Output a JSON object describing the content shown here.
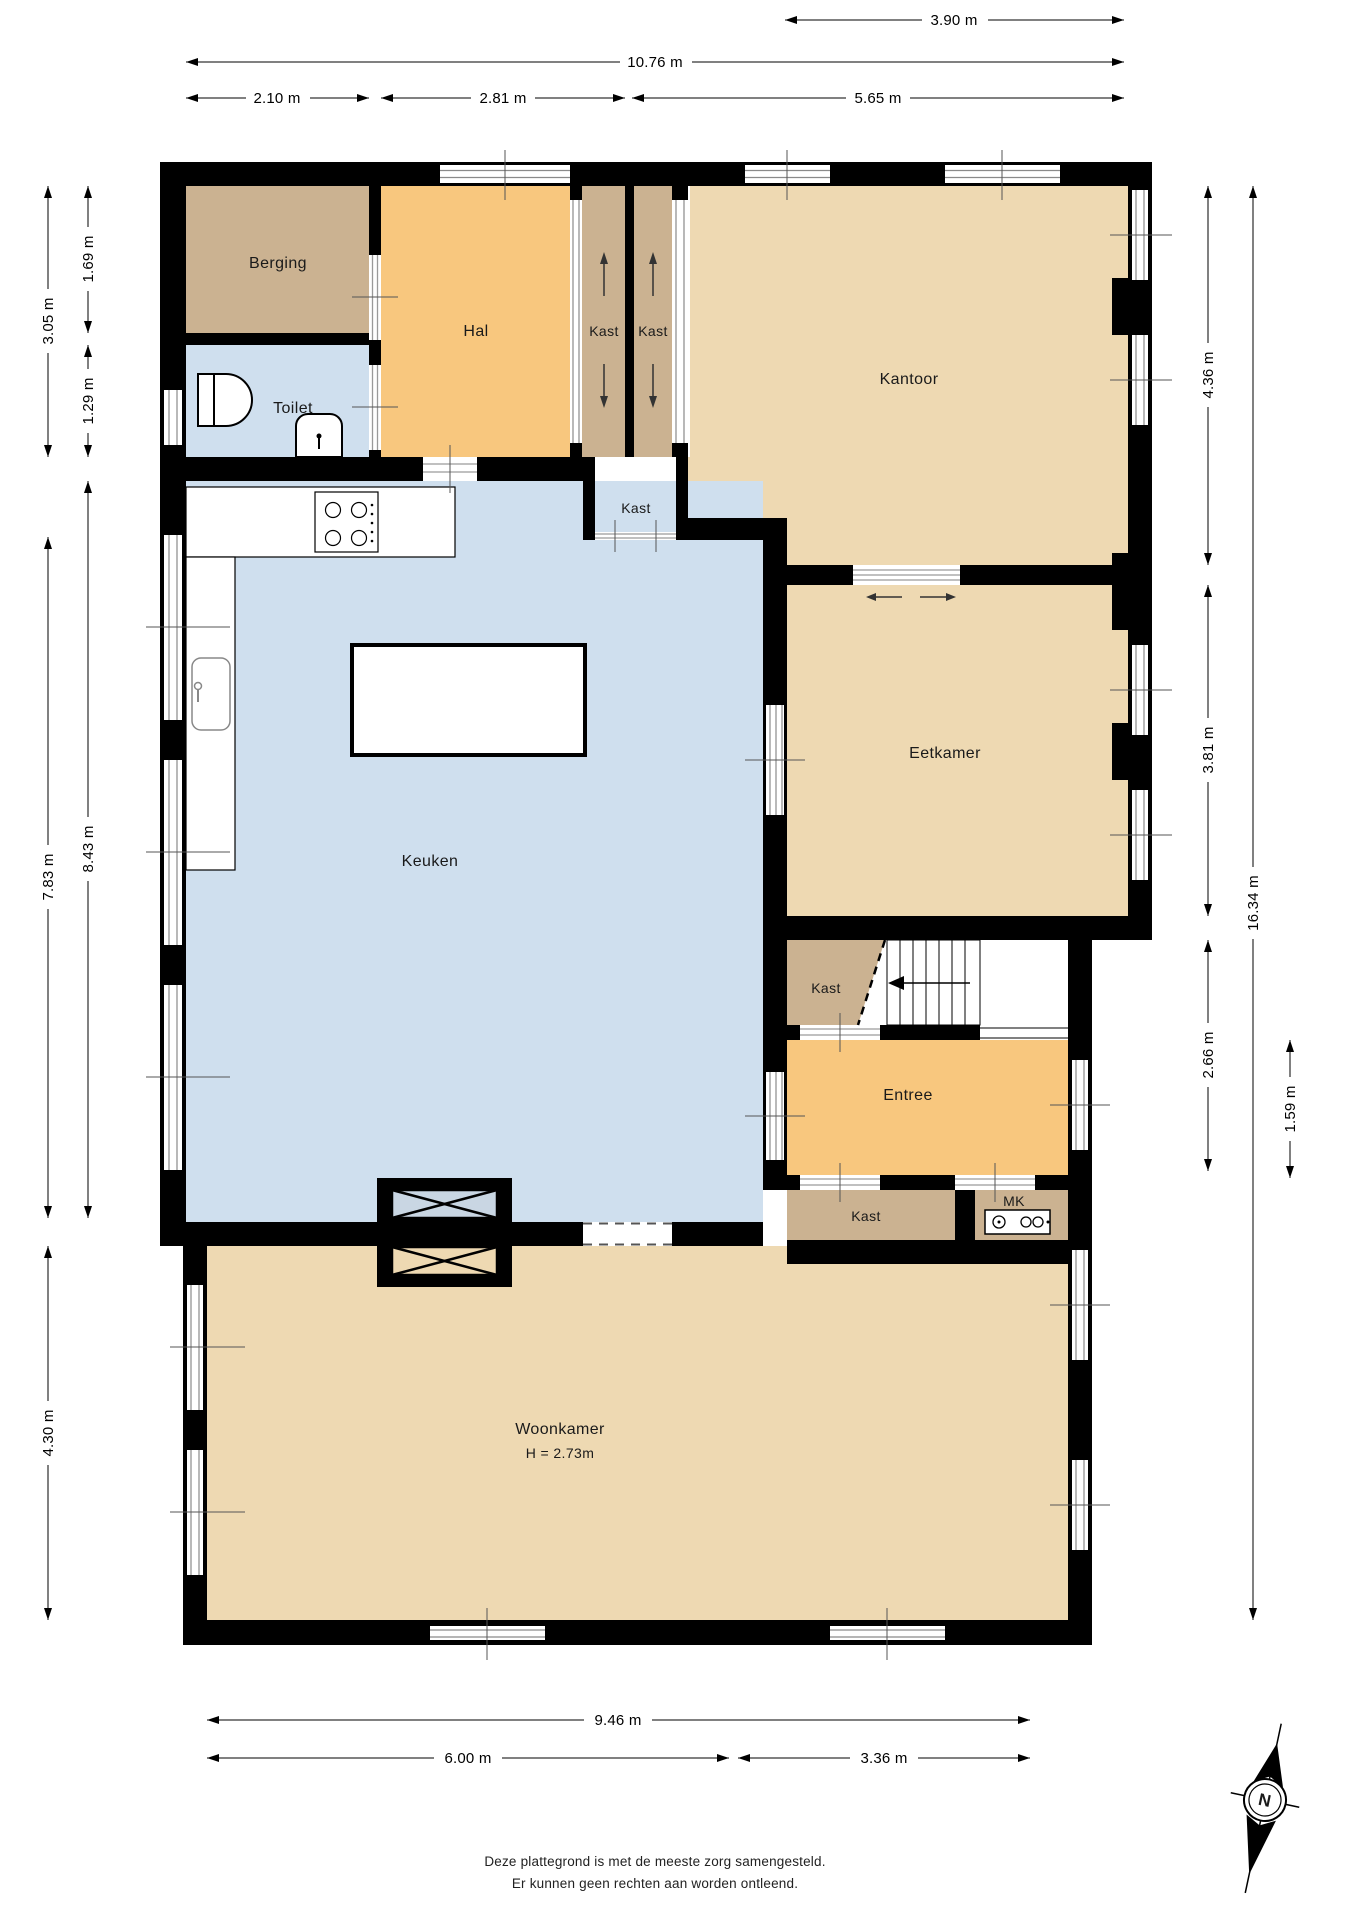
{
  "rooms": {
    "berging": {
      "label": "Berging"
    },
    "toilet": {
      "label": "Toilet"
    },
    "hal": {
      "label": "Hal"
    },
    "kast_closet_1": {
      "label": "Kast"
    },
    "kast_closet_2": {
      "label": "Kast"
    },
    "kantoor": {
      "label": "Kantoor"
    },
    "kast_small": {
      "label": "Kast"
    },
    "keuken": {
      "label": "Keuken"
    },
    "eetkamer": {
      "label": "Eetkamer"
    },
    "kast_stairs": {
      "label": "Kast"
    },
    "entree": {
      "label": "Entree"
    },
    "kast_hall": {
      "label": "Kast"
    },
    "mk": {
      "label": "MK"
    },
    "woonkamer": {
      "label": "Woonkamer",
      "height_note": "H = 2.73m"
    }
  },
  "dimensions": {
    "top": [
      {
        "label": "3.90 m"
      },
      {
        "label": "10.76 m"
      },
      {
        "label": "2.10 m"
      },
      {
        "label": "2.81 m"
      },
      {
        "label": "5.65 m"
      }
    ],
    "left": [
      {
        "label": "3.05 m"
      },
      {
        "label": "1.69 m"
      },
      {
        "label": "1.29 m"
      },
      {
        "label": "7.83 m"
      },
      {
        "label": "8.43 m"
      },
      {
        "label": "4.30 m"
      }
    ],
    "right": [
      {
        "label": "4.36 m"
      },
      {
        "label": "3.81 m"
      },
      {
        "label": "2.66 m"
      },
      {
        "label": "16.34 m"
      },
      {
        "label": "1.59 m"
      }
    ],
    "bottom": [
      {
        "label": "9.46 m"
      },
      {
        "label": "6.00 m"
      },
      {
        "label": "3.36 m"
      }
    ]
  },
  "compass": {
    "north_label": "N"
  },
  "footer": {
    "line1": "Deze plattegrond is met de meeste zorg samengesteld.",
    "line2": "Er kunnen geen rechten aan worden ontleend."
  },
  "colors": {
    "wall": "#000000",
    "room_tan": "#eed9b2",
    "room_orange": "#f8c77e",
    "room_brown": "#cbb291",
    "room_blue": "#cfdfee",
    "xbox_blue": "#c9d6e3",
    "window_line": "#8a8a8a"
  }
}
